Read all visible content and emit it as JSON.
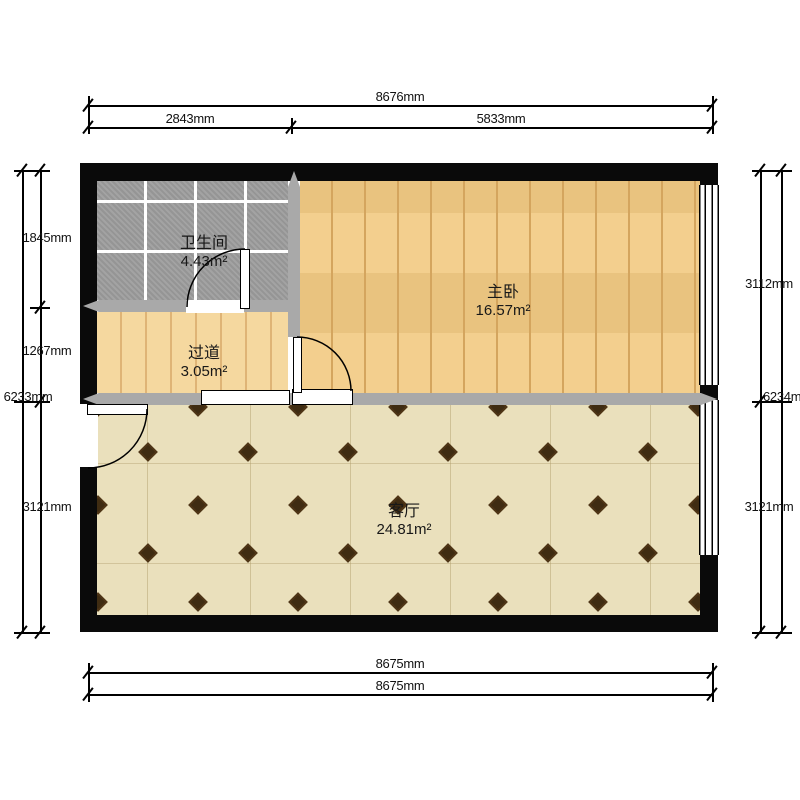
{
  "rooms": {
    "bathroom": {
      "name": "卫生间",
      "area": "4.43m²"
    },
    "hallway": {
      "name": "过道",
      "area": "3.05m²"
    },
    "bedroom": {
      "name": "主卧",
      "area": "16.57m²"
    },
    "living": {
      "name": "客厅",
      "area": "24.81m²"
    }
  },
  "dimensions": {
    "top_total": "8676mm",
    "top_seg1": "2843mm",
    "top_seg2": "5833mm",
    "bottom_line1": "8675mm",
    "bottom_line2": "8675mm",
    "left_total": "6233mm",
    "left_seg1": "1845mm",
    "left_seg2": "1267mm",
    "left_seg3": "3121mm",
    "right_total": "6234mm",
    "right_seg1": "3112mm",
    "right_seg2": "3121mm"
  },
  "colors": {
    "exterior_wall": "#0a0a0a",
    "interior_wall": "#a9a9a9",
    "bathroom_tile": "#9d9d9d",
    "hallway_wood": "#f5d89f",
    "bedroom_wood": "#f2cb84",
    "living_tile": "#eae0bc",
    "diamond_accent": "#3f2c12"
  }
}
